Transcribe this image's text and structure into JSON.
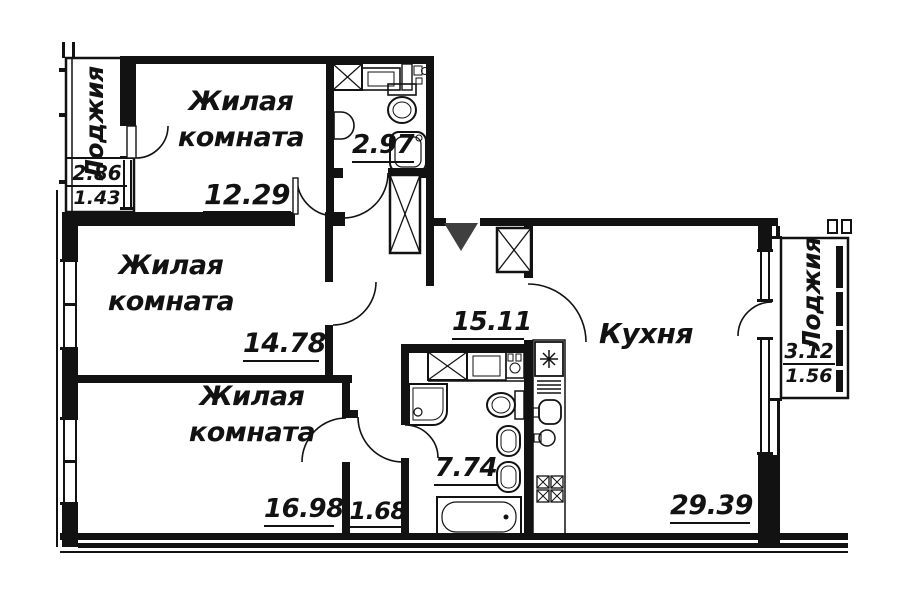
{
  "rooms": {
    "living1": {
      "name_line1": "Жилая",
      "name_line2": "комната",
      "area": "12.29"
    },
    "living2": {
      "name_line1": "Жилая",
      "name_line2": "комната",
      "area": "14.78"
    },
    "living3": {
      "name_line1": "Жилая",
      "name_line2": "комната",
      "area": "16.98"
    },
    "kitchen": {
      "name": "Кухня",
      "area": "29.39"
    },
    "hallway": {
      "area": "15.11"
    },
    "bathroom_small": {
      "area": "2.97"
    },
    "bathroom_large": {
      "area": "7.74"
    },
    "corridor": {
      "area": "1.68"
    },
    "loggia_left": {
      "name": "Лоджия",
      "area_total": "2.86",
      "area_counted": "1.43"
    },
    "loggia_right": {
      "name": "Лоджия",
      "area_total": "3.12",
      "area_counted": "1.56"
    }
  },
  "colors": {
    "line": "#121212",
    "background": "#ffffff",
    "entrance_marker": "#3f3f3f"
  }
}
